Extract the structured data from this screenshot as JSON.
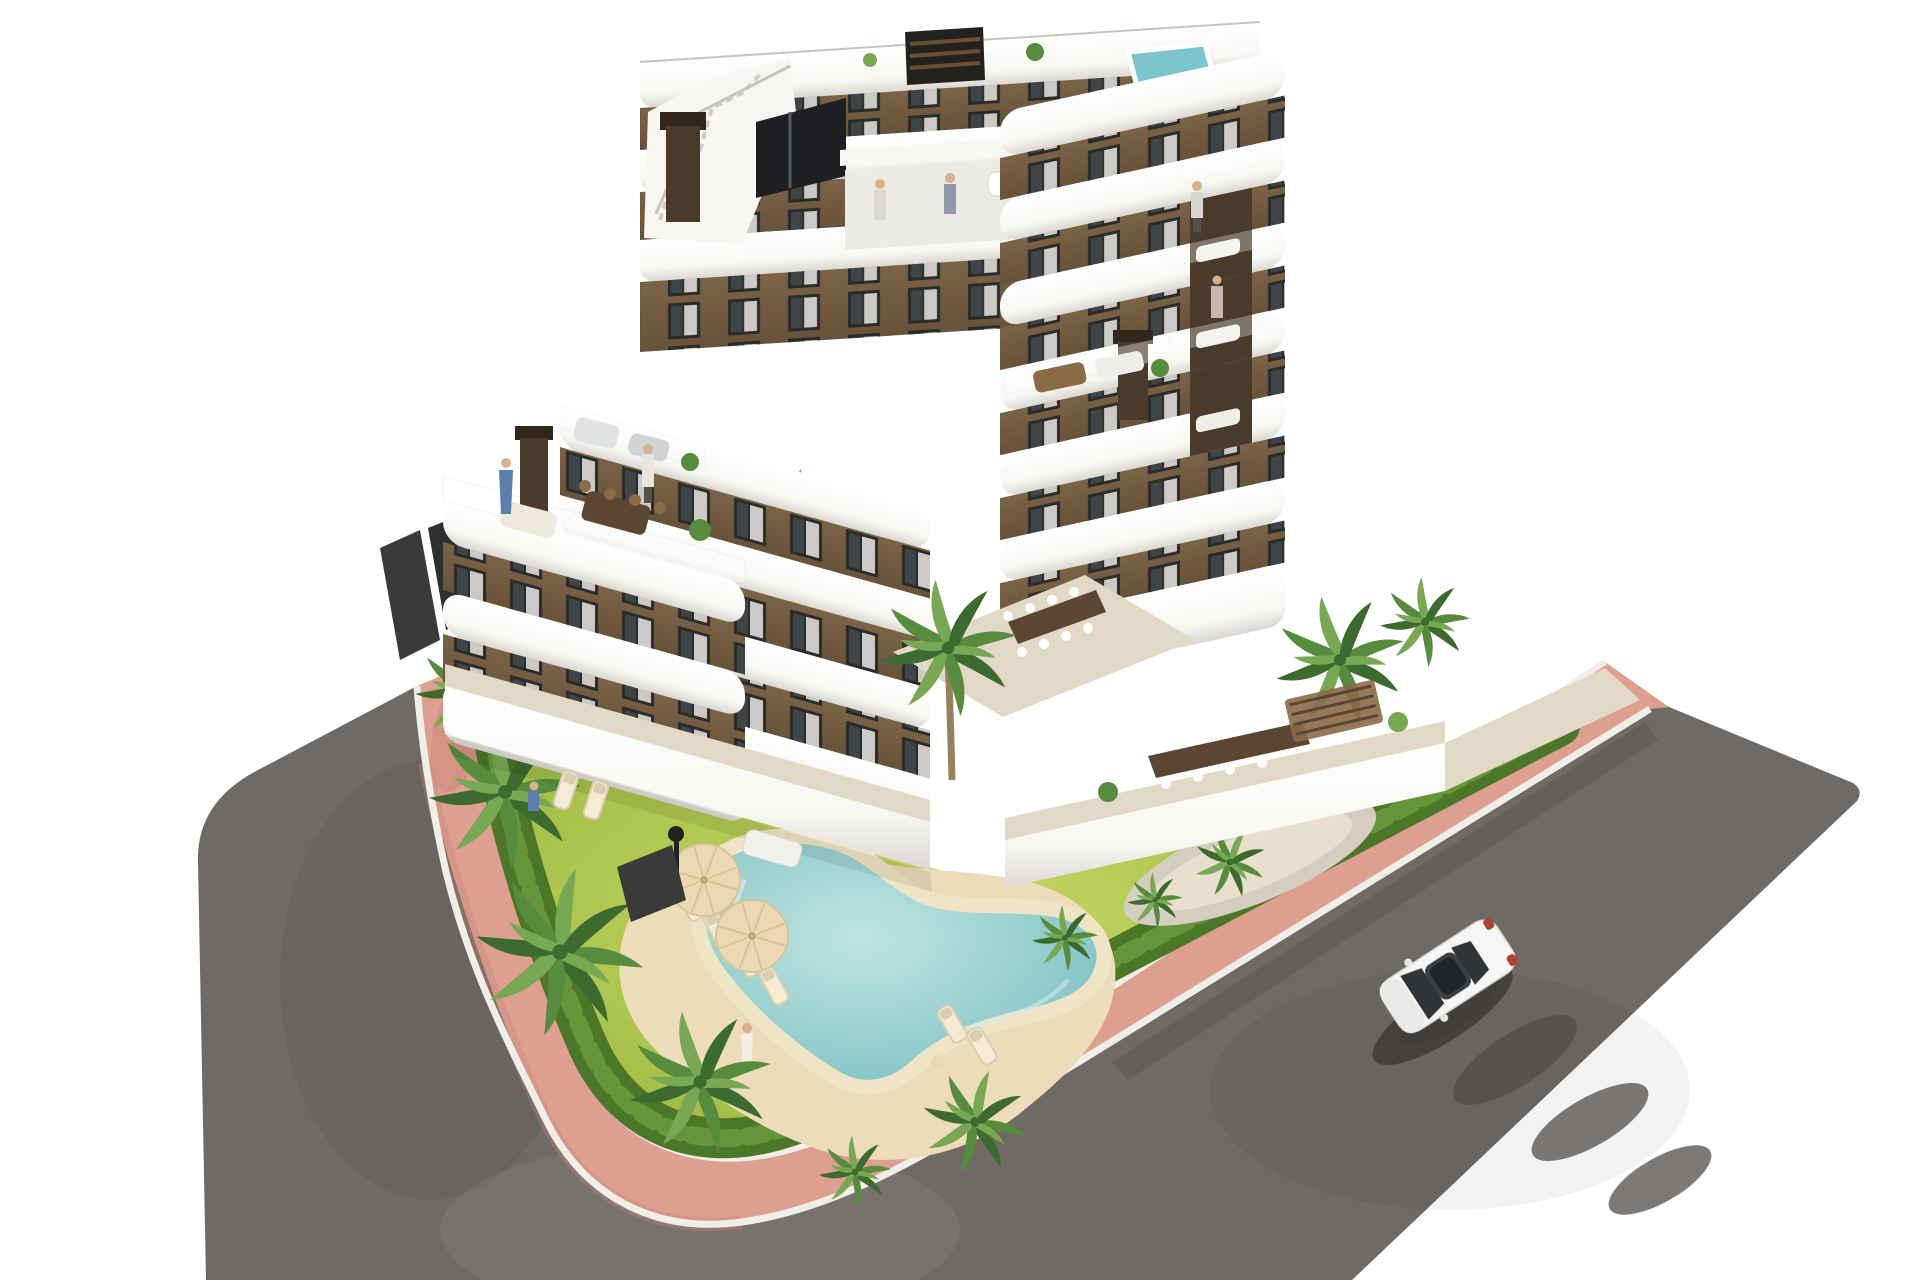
{
  "scene": {
    "type": "architectural-render",
    "description": "Aerial 3D rendering of a modern stepped apartment building with brown facades and curved white balconies, set on a corner plot with a tropical garden, free-form pool, salmon-pink sidewalk and asphalt streets with a single white car.",
    "building": {
      "facade_color_name": "brown",
      "balcony_color_name": "white",
      "floors_visible": 6,
      "features": [
        "curved white balcony bands",
        "stepped roof terraces",
        "rooftop plunge pool",
        "stair bulkhead",
        "brown chimneys",
        "glass railings",
        "dark framed windows",
        "terrace furniture"
      ]
    },
    "garden": {
      "features": [
        "free-form swimming pool",
        "sandy pool deck",
        "sun loungers",
        "parasols",
        "palm trees",
        "lawn",
        "perimeter hedge",
        "gravel planting beds",
        "garden lamp"
      ]
    },
    "streets": {
      "features": [
        "dark asphalt road",
        "salmon-pink sidewalk",
        "white curbs",
        "tree shadows on asphalt"
      ]
    },
    "counts": {
      "people": 9,
      "cars": 1,
      "palm_trees": 13,
      "sun_loungers": 7,
      "parasols": 2,
      "chimneys": 2
    }
  },
  "palette": {
    "bg": "#ffffff",
    "road": "#6f6a65",
    "roadShadow": "#514d48",
    "curb": "#f0eee8",
    "path": "#dd9f8f",
    "pathShade": "#c98878",
    "hedge": "#4c7729",
    "hedgeLight": "#6d9c3e",
    "grass": "#a9c24b",
    "grassLight": "#c6d765",
    "grassDark": "#8ca839",
    "palmDark": "#3d6a2e",
    "palmMid": "#578c3e",
    "palmLight": "#79a855",
    "trunk": "#96815f",
    "sand": "#ecdcba",
    "sandLight": "#f5ebd3",
    "gravel": "#d4cdc0",
    "poolRim": "#efe4c6",
    "water": "#9ed3d2",
    "waterDeep": "#79bcc0",
    "facade": "#7b6347",
    "facadeShade": "#68523a",
    "facadeDark": "#4a3a29",
    "bandWhite": "#f7f6f2",
    "bandShade": "#dcd8d1",
    "bandEdge": "#c9c5bd",
    "win": "#2b2b28",
    "glass": "#3e4549",
    "glassLight": "#aab3b6",
    "curtain": "#e9e7e2",
    "terrace": "#e2d8c6",
    "terraceShade": "#cfc4b0",
    "tealPool": "#7cc5cd",
    "dark": "#23221f",
    "carBody": "#f5f5f3",
    "carGlass": "#2e3438",
    "carShadow": "#3f3b37",
    "tailRed": "#b0402f",
    "accentBlue": "#5c80ab",
    "cream": "#e9d8b2",
    "wood": "#8a6a47",
    "woodDark": "#5a4632"
  }
}
